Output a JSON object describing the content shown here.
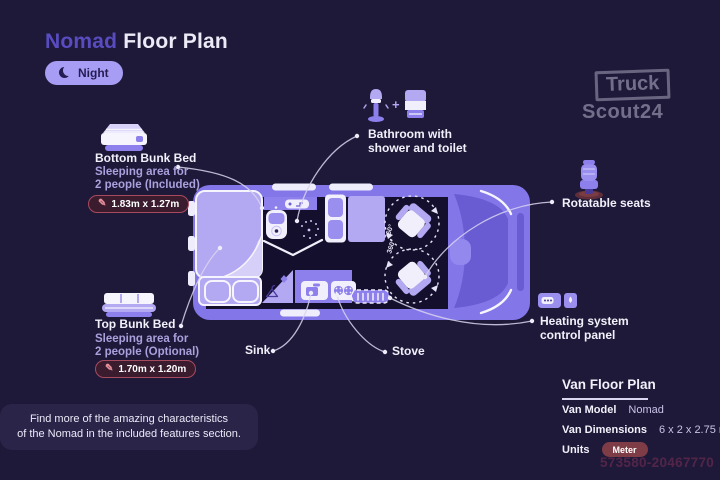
{
  "header": {
    "title_accent": "Nomad",
    "title_rest": "Floor Plan",
    "mode": {
      "label": "Night",
      "icon": "moon-icon"
    }
  },
  "brand": {
    "line1": "Truck",
    "line2": "Scout24"
  },
  "callouts": {
    "bottom_bunk": {
      "title": "Bottom Bunk Bed",
      "subtitle1": "Sleeping area for",
      "subtitle2": "2 people (Included)",
      "dimensions": "1.83m x 1.27m",
      "icon": "bottom-bunk-bed-icon",
      "edit_icon": "pencil-icon"
    },
    "top_bunk": {
      "title": "Top Bunk Bed",
      "subtitle1": "Sleeping area for",
      "subtitle2": "2 people (Optional)",
      "dimensions": "1.70m x 1.20m",
      "icon": "top-bunk-bed-icon",
      "edit_icon": "pencil-icon"
    },
    "bathroom": {
      "plus": "+",
      "line1": "Bathroom with",
      "line2": "shower and toilet",
      "icons": [
        "shower-icon",
        "toilet-icon"
      ]
    },
    "rotatable_seats": {
      "label": "Rotatable seats",
      "icon": "seat-icon"
    },
    "heating": {
      "line1": "Heating system",
      "line2": "control panel",
      "icon": "heating-panel-icon"
    },
    "sink": {
      "label": "Sink"
    },
    "stove": {
      "label": "Stove"
    }
  },
  "floorplan": {
    "seat_rotation_front": "360°",
    "seat_rotation_rear": "360°"
  },
  "info_panel": {
    "title": "Van Floor Plan",
    "rows": [
      {
        "label": "Van Model",
        "value": "Nomad"
      },
      {
        "label": "Van Dimensions",
        "value": "6 x 2 x 2.75 m"
      },
      {
        "label": "Units",
        "value": "Meter"
      }
    ]
  },
  "footer": {
    "line1": "Find more of the amazing characteristics",
    "line2": "of the Nomad in the included features section."
  },
  "watermark_id": "573580-20467770",
  "colors": {
    "background": "#1f1939",
    "accent_purple": "#584cc0",
    "night_pill": "#a89df5",
    "van_body": "#8276e9",
    "van_light": "#b3a8f2",
    "van_interior": "#140f2c",
    "badge_bg": "#3a1c2e",
    "badge_border": "#a84a5e",
    "meter_badge": "#7d3c46",
    "footer_bg": "#2a2449"
  }
}
